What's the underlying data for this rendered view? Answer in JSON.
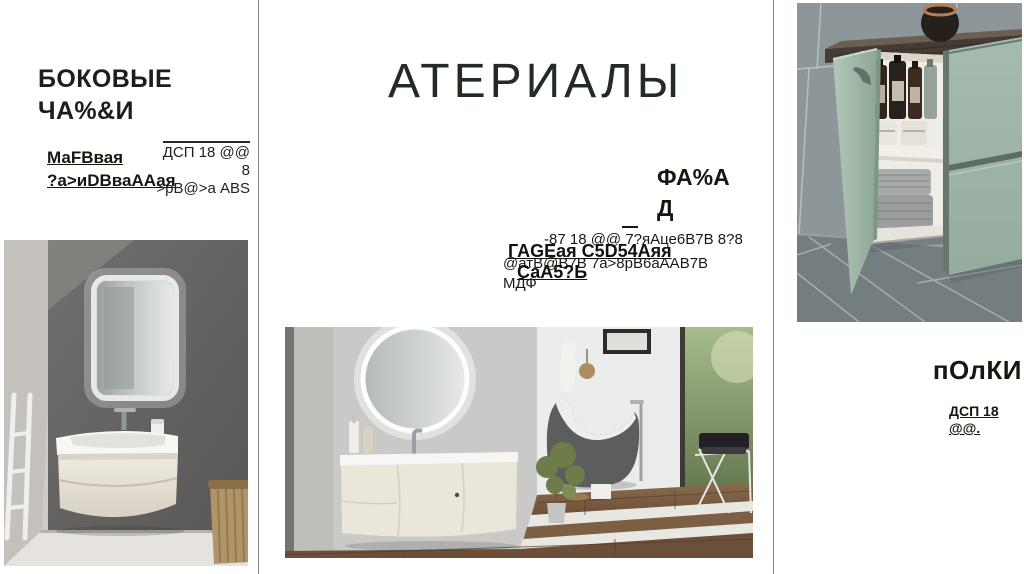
{
  "title": "АТЕРИАЛЫ",
  "left_panel": {
    "heading_lines": [
      "БОКОВЫЕ",
      "ЧА%&И"
    ],
    "subheading_lines": [
      "МаFВвая",
      "?а>иDВваААая"
    ],
    "spec_lines": [
      "ДСП 18 @@",
      "8",
      ">рВ@>а ABS"
    ],
    "image_caption": "bathroom-vanity-with-led-mirror-and-wicker-basket"
  },
  "center_panel": {
    "heading_lines": [
      "ФА%А",
      "Д"
    ],
    "bold_spec_lines": [
      "ГАGЕая С5D54Аяя",
      "СаА5?Ь"
    ],
    "body_lines": [
      "-87 18 @@ 7?яАце6В7В 8?8",
      "@атВ@В7В 7а>8рВ6аААВ7В",
      "МДФ"
    ],
    "image_caption": "bathroom-with-round-led-mirror-curved-vanity-and-freestanding-bathtub"
  },
  "right_panel": {
    "heading": "пОлКИ",
    "spec_lines": [
      "ДСП 18",
      "@@."
    ],
    "image_caption": "sage-green-cabinet-open-door-with-bottles-and-towels"
  },
  "colors": {
    "background": "#ffffff",
    "divider": "#7a8a7d",
    "heading_text": "#14180f",
    "title_text": "#222b24",
    "cabinet_green": "#9fb5a7"
  }
}
